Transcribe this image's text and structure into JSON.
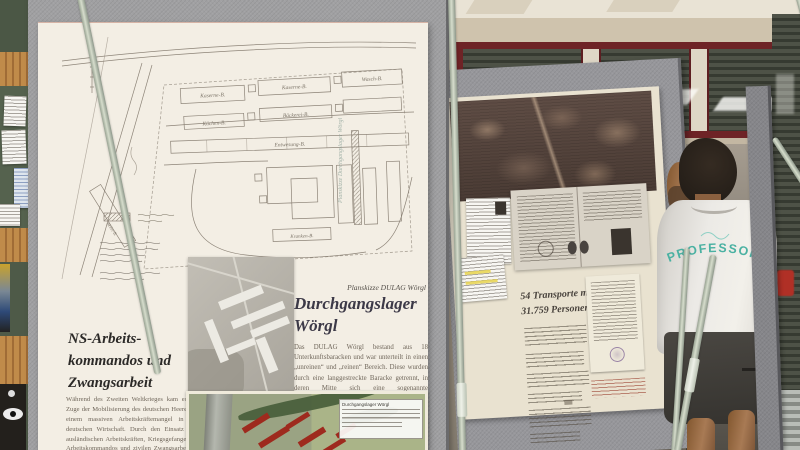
{
  "colors": {
    "board_grey": "#9b9b9d",
    "poster_cream": "#f3eee4",
    "window_frame_red": "#6e2326",
    "shirt_print_teal": "#4ab1a2",
    "map_overlay_red": "#9e2a1e"
  },
  "posters": {
    "left": {
      "plan_caption": "Planskizze DULAG Wörgl",
      "plan_side_note": "Planskizze Durchgangslager Wörgl",
      "plan_labels": [
        "Kaserne-B.",
        "Kaserne-B.",
        "Wasch-B.",
        "Küchen-B.",
        "Bäckerei-B.",
        "Entwesung-B.",
        "Kranken-B.",
        "Wohn-B."
      ],
      "section_left": {
        "title_lines": [
          "NS-Arbeits-",
          "kommandos und",
          "Zwangsarbeit"
        ],
        "body": "Während des Zweiten Weltkrieges kam es im Zuge der Mobilisierung des deutschen Heeres zu einem massiven Arbeitskräftemangel in der deutschen Wirtschaft. Durch den Einsatz von ausländischen Arbeitskräften, Kriegsgefangenen-Arbeitskommandos und zivilen Zwangsarbeitern wurde versucht,"
      },
      "section_right": {
        "title_lines": [
          "Durchgangslager",
          "Wörgl"
        ],
        "body": "Das DULAG Wörgl bestand aus 18 Unterkunftsbaracken und war unterteilt in einen „unreinen“ und „reinen“ Bereich. Diese wurden durch eine langgestreckte Baracke getrennt, in deren Mitte sich eine sogenannte „Entwesungsanlage“ mit Desinfektion befand."
      },
      "aerial_legend_title": "Durchgangslager Wörgl"
    },
    "right": {
      "title_lines": [
        "54 Transporte mit",
        "31.759 Personen"
      ]
    }
  },
  "person": {
    "shirt_text": "PROFESSOR"
  }
}
